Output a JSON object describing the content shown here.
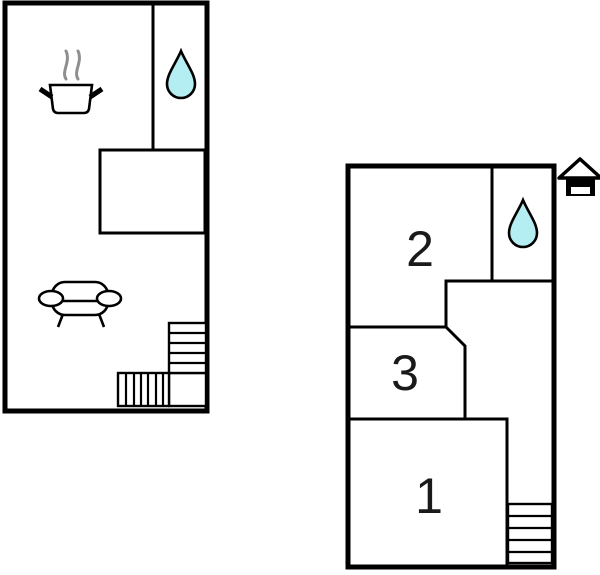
{
  "scene": {
    "type": "floor-plan",
    "background": "#ffffff",
    "colors": {
      "wall": "#000000",
      "water_drop_fill": "#b5eef2",
      "steam": "#8f8f8f",
      "label": "#1a1a1a"
    },
    "plans": [
      {
        "id": "left-floor",
        "rooms": [],
        "icons": [
          {
            "name": "cooking-pot-icon"
          },
          {
            "name": "steam-icon"
          },
          {
            "name": "water-drop-icon"
          },
          {
            "name": "sofa-icon"
          },
          {
            "name": "stairs-icon"
          }
        ]
      },
      {
        "id": "right-floor",
        "rooms": [
          {
            "label": "2"
          },
          {
            "label": "3"
          },
          {
            "label": "1"
          }
        ],
        "icons": [
          {
            "name": "water-drop-icon"
          },
          {
            "name": "stairs-icon"
          },
          {
            "name": "house-icon"
          }
        ]
      }
    ]
  }
}
